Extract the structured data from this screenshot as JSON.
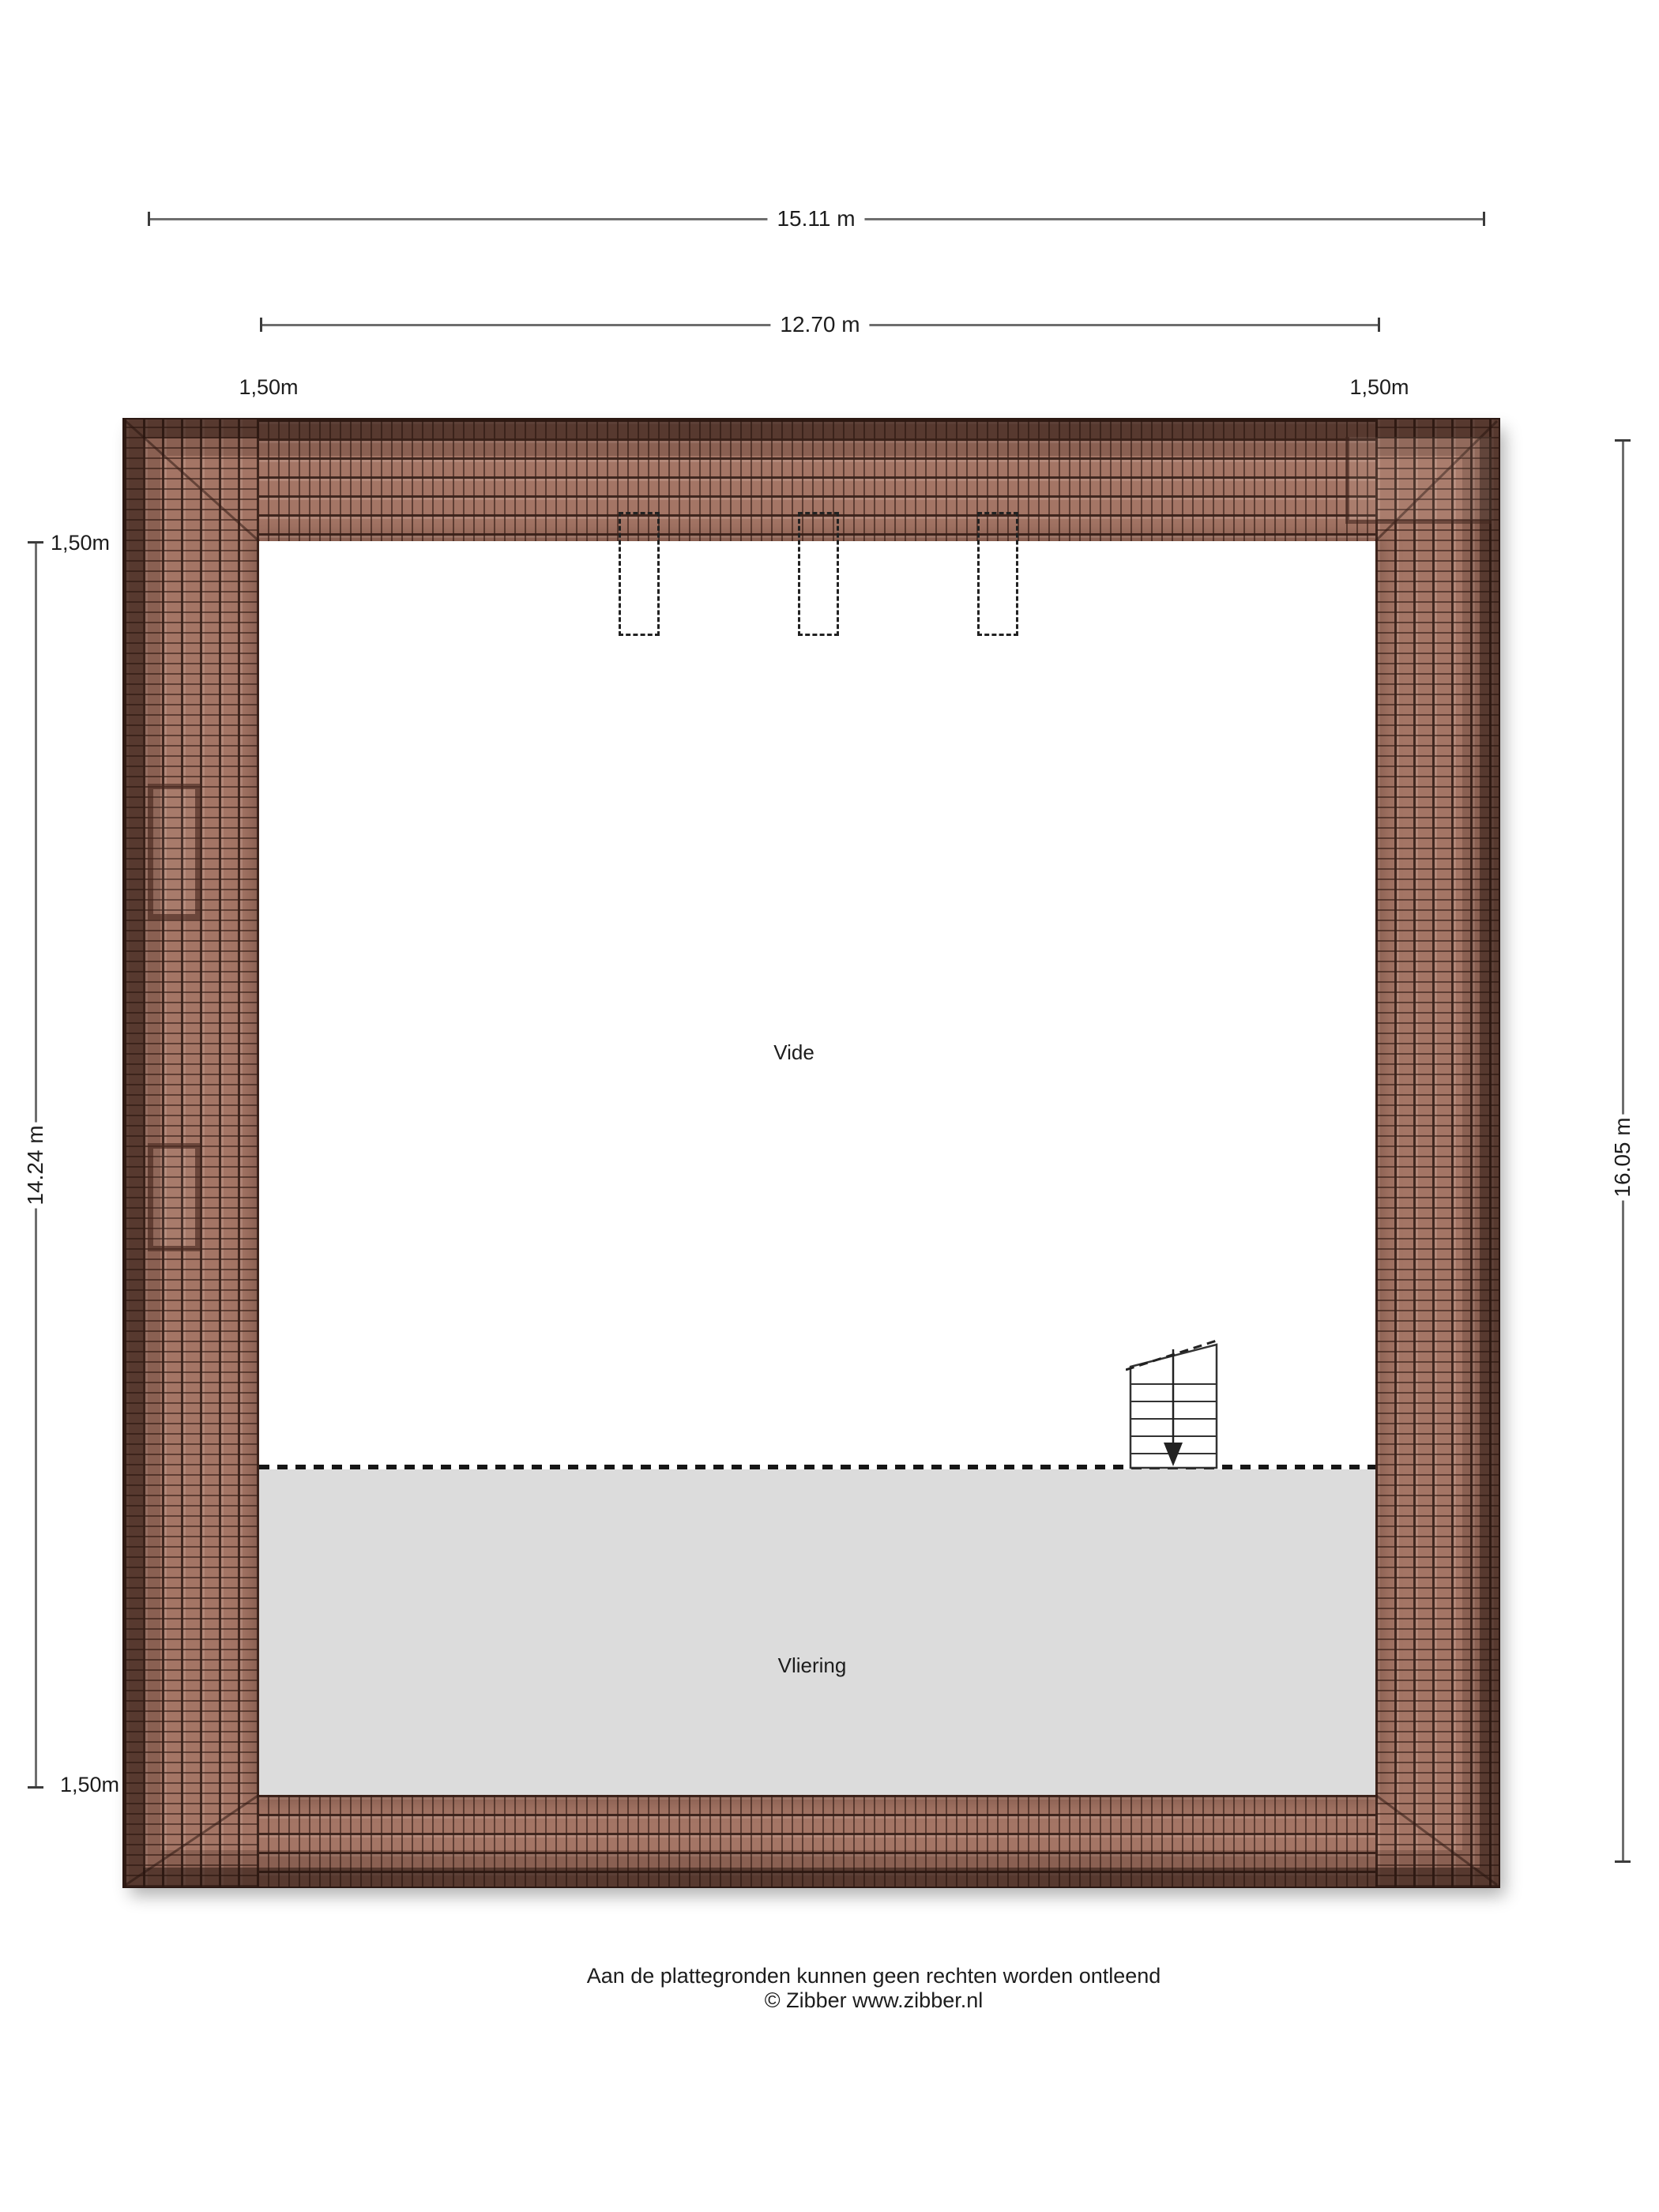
{
  "dimensions": {
    "total_width": "15.11 m",
    "inner_width": "12.70 m",
    "offset_top_left": "1,50m",
    "offset_top_right": "1,50m",
    "left_segment_top": "1,50m",
    "left_height": "14.24 m",
    "left_segment_bottom": "1,50m",
    "total_height": "16.05 m"
  },
  "rooms": {
    "vide": "Vide",
    "vliering": "Vliering"
  },
  "footer": {
    "line1": "Aan de plattegronden kunnen geen rechten worden ontleend",
    "line2": "© Zibber www.zibber.nl"
  },
  "colors": {
    "roof_tile_light": "#a47565",
    "roof_tile_dark": "#5a372e",
    "roof_tile_line": "#3a2119",
    "vliering_gray": "#dcdcdc",
    "dimension_line": "#6e6e6e",
    "text": "#1d1d1d",
    "background": "#ffffff"
  }
}
